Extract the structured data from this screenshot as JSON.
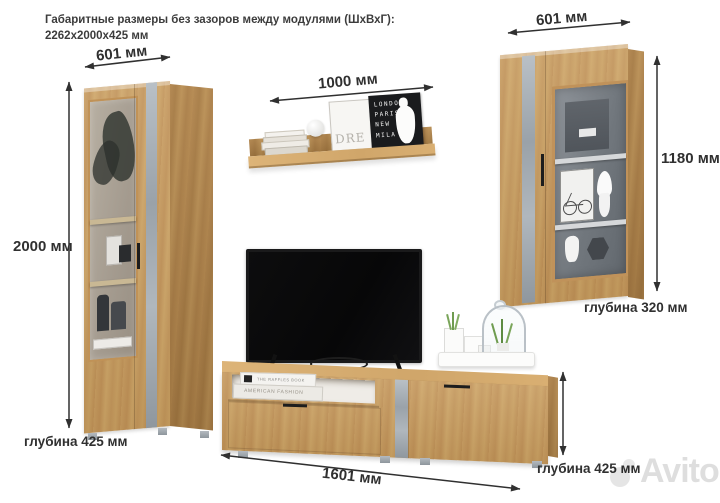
{
  "title": {
    "line1": "Габаритные размеры без зазоров между модулями (ШхВхГ):",
    "line2": "2262х2000х425 мм"
  },
  "dimensions": {
    "left_cabinet": {
      "width": "601 мм",
      "height": "2000 мм",
      "depth": "глубина 425 мм"
    },
    "shelf": {
      "width": "1000 мм"
    },
    "right_cabinet": {
      "width": "601 мм",
      "height": "1180 мм",
      "depth": "глубина 320 мм"
    },
    "tv_stand": {
      "width": "1601 мм",
      "depth": "глубина 425 мм"
    }
  },
  "decor": {
    "letterboard_lines": [
      "LONDO",
      "PARIS",
      "NEW",
      "MILA"
    ],
    "frame_text": "DRE",
    "niche_book_top": "THE RAFFLES BOOK",
    "niche_book_bottom": "AMERICAN FASHION"
  },
  "watermark": {
    "text": "Avito"
  },
  "colors": {
    "wood": "#c6995c",
    "wood_dark": "#a97f45",
    "concrete": "#a9b0b6",
    "dimension_text": "#303030",
    "watermark_gray": "#d9d9d9"
  }
}
